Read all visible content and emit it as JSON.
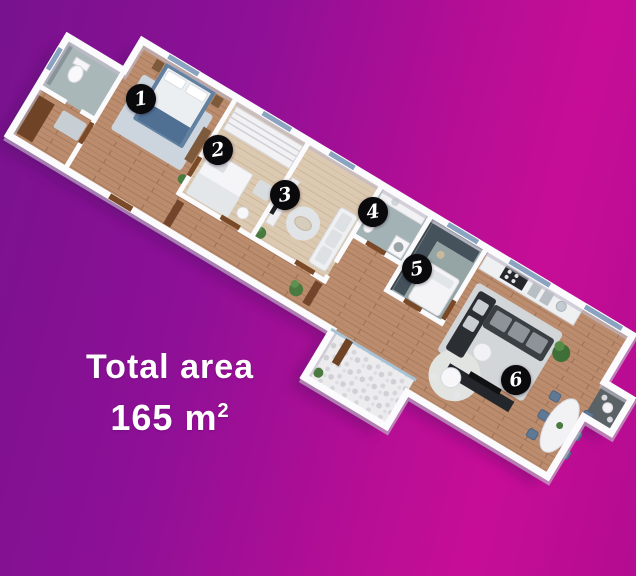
{
  "overlay": {
    "title": "Total area",
    "area_value": "165 m",
    "area_sup": "2"
  },
  "background": {
    "gradient_left": "#78128e",
    "gradient_right": "#c70d97",
    "marker_bg": "#0a0a0c",
    "marker_text": "#ffffff",
    "wall_color": "#fbfbfd",
    "wood_floor": "#b98a6a",
    "light_floor": "#d9c6ae",
    "bath_floor": "#a3b2b4"
  },
  "plan": {
    "rooms": [
      {
        "number": "1",
        "name": "bedroom"
      },
      {
        "number": "2",
        "name": "bedroom-2"
      },
      {
        "number": "3",
        "name": "tv-room"
      },
      {
        "number": "4",
        "name": "bathroom"
      },
      {
        "number": "5",
        "name": "spa-lounge"
      },
      {
        "number": "6",
        "name": "living-dining-kitchen"
      }
    ]
  }
}
